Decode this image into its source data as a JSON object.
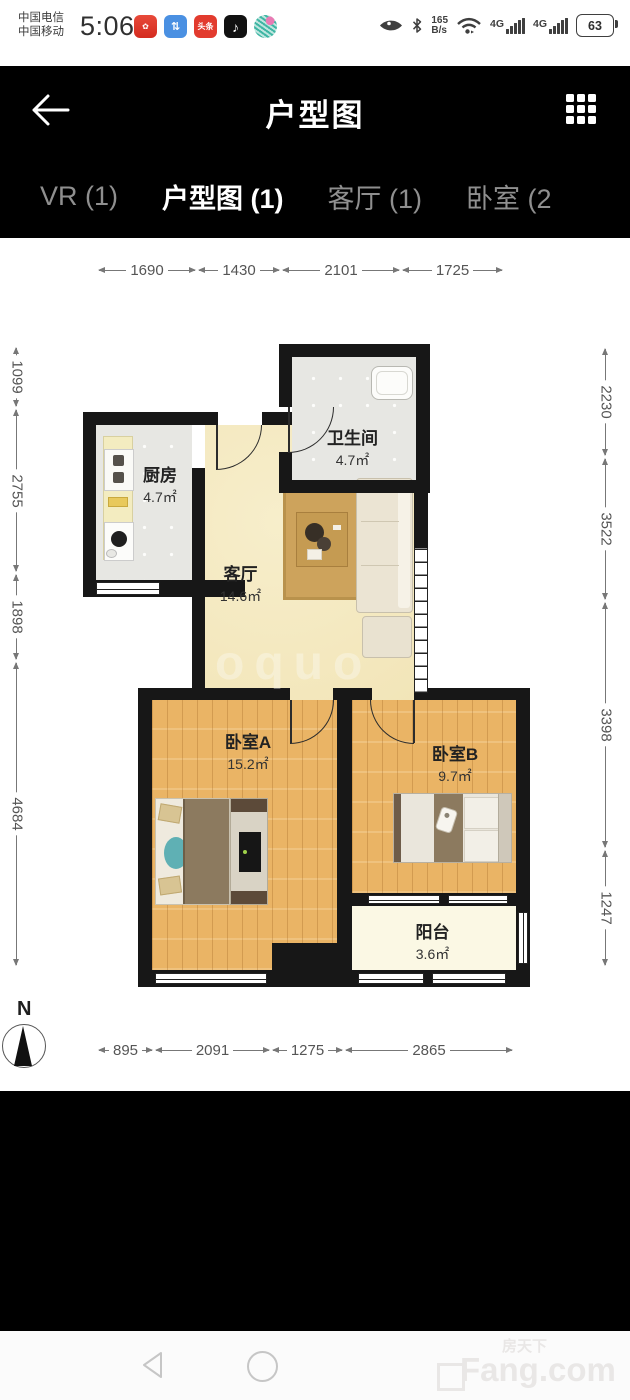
{
  "status_bar": {
    "carrier_line1": "中国电信",
    "carrier_line2": "中国移动",
    "time": "5:06",
    "app_icons": [
      "red-app-icon",
      "blue-app-icon",
      "toutiao-icon",
      "tiktok-icon",
      "migu-swirl-icon"
    ],
    "toutiao_label": "头条",
    "right_icons": [
      "eye-icon",
      "bluetooth-icon",
      "wifi-icon"
    ],
    "net_speed_value": "165",
    "net_speed_unit": "B/s",
    "cell1_label": "4G",
    "cell2_label": "4G",
    "battery_percent": "63"
  },
  "header": {
    "title": "户型图"
  },
  "tabs": [
    {
      "label": "VR (1)",
      "active": false
    },
    {
      "label": "户型图 (1)",
      "active": true
    },
    {
      "label": "客厅 (1)",
      "active": false
    },
    {
      "label": "卧室 (2",
      "active": false
    }
  ],
  "plan": {
    "rooms": [
      {
        "name": "厨房",
        "area": "4.7㎡"
      },
      {
        "name": "卫生间",
        "area": "4.7㎡"
      },
      {
        "name": "客厅",
        "area": "14.6㎡"
      },
      {
        "name": "卧室A",
        "area": "15.2㎡"
      },
      {
        "name": "卧室B",
        "area": "9.7㎡"
      },
      {
        "name": "阳台",
        "area": "3.6㎡"
      }
    ],
    "dims_top": [
      "1690",
      "1430",
      "2101",
      "1725"
    ],
    "dims_bottom": [
      "895",
      "2091",
      "1275",
      "2865"
    ],
    "dims_left": [
      "1099",
      "2755",
      "1898",
      "4684"
    ],
    "dims_right": [
      "2230",
      "3522",
      "3398",
      "1247"
    ],
    "compass_label": "N",
    "center_watermark": "oquo"
  },
  "nav_bar": {
    "watermark_cn": "房天下",
    "watermark_en": "Fang.com"
  },
  "colors": {
    "wall": "#171717",
    "wood_floor": "#eab465",
    "tile_floor": "#e7e7e3",
    "living_floor": "#f5eac3",
    "balcony_floor": "#fbf8e4",
    "accent_teal": "#5fb0b4"
  }
}
